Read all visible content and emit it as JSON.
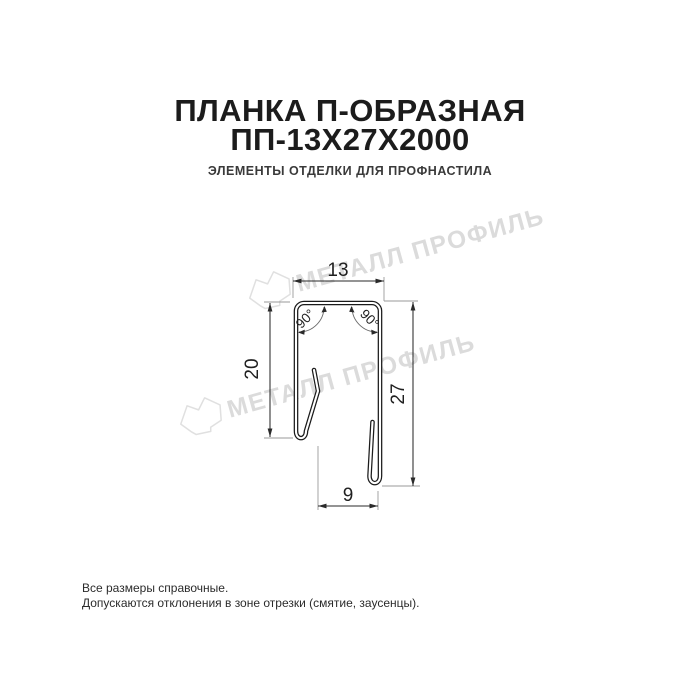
{
  "header": {
    "title_line1": "ПЛАНКА П-ОБРАЗНАЯ",
    "title_line2": "ПП-13Х27Х2000",
    "subtitle": "ЭЛЕМЕНТЫ ОТДЕЛКИ ДЛЯ ПРОФНАСТИЛА"
  },
  "drawing": {
    "dimensions": {
      "top_width": "13",
      "left_height": "20",
      "right_height": "27",
      "bottom_width": "9",
      "angle_left": "90°",
      "angle_right": "90°"
    },
    "colors": {
      "profile_line": "#1b1b1b",
      "dimension_line": "#2a2a2a",
      "extension_line": "#9a9a9a"
    }
  },
  "watermark": {
    "text": "МЕТАЛЛ ПРОФИЛЬ",
    "color": "#dbdbdb",
    "logo_color": "#e0e0e0"
  },
  "footer": {
    "line1": "Все размеры справочные.",
    "line2": "Допускаются отклонения в зоне отрезки (смятие, заусенцы)."
  }
}
